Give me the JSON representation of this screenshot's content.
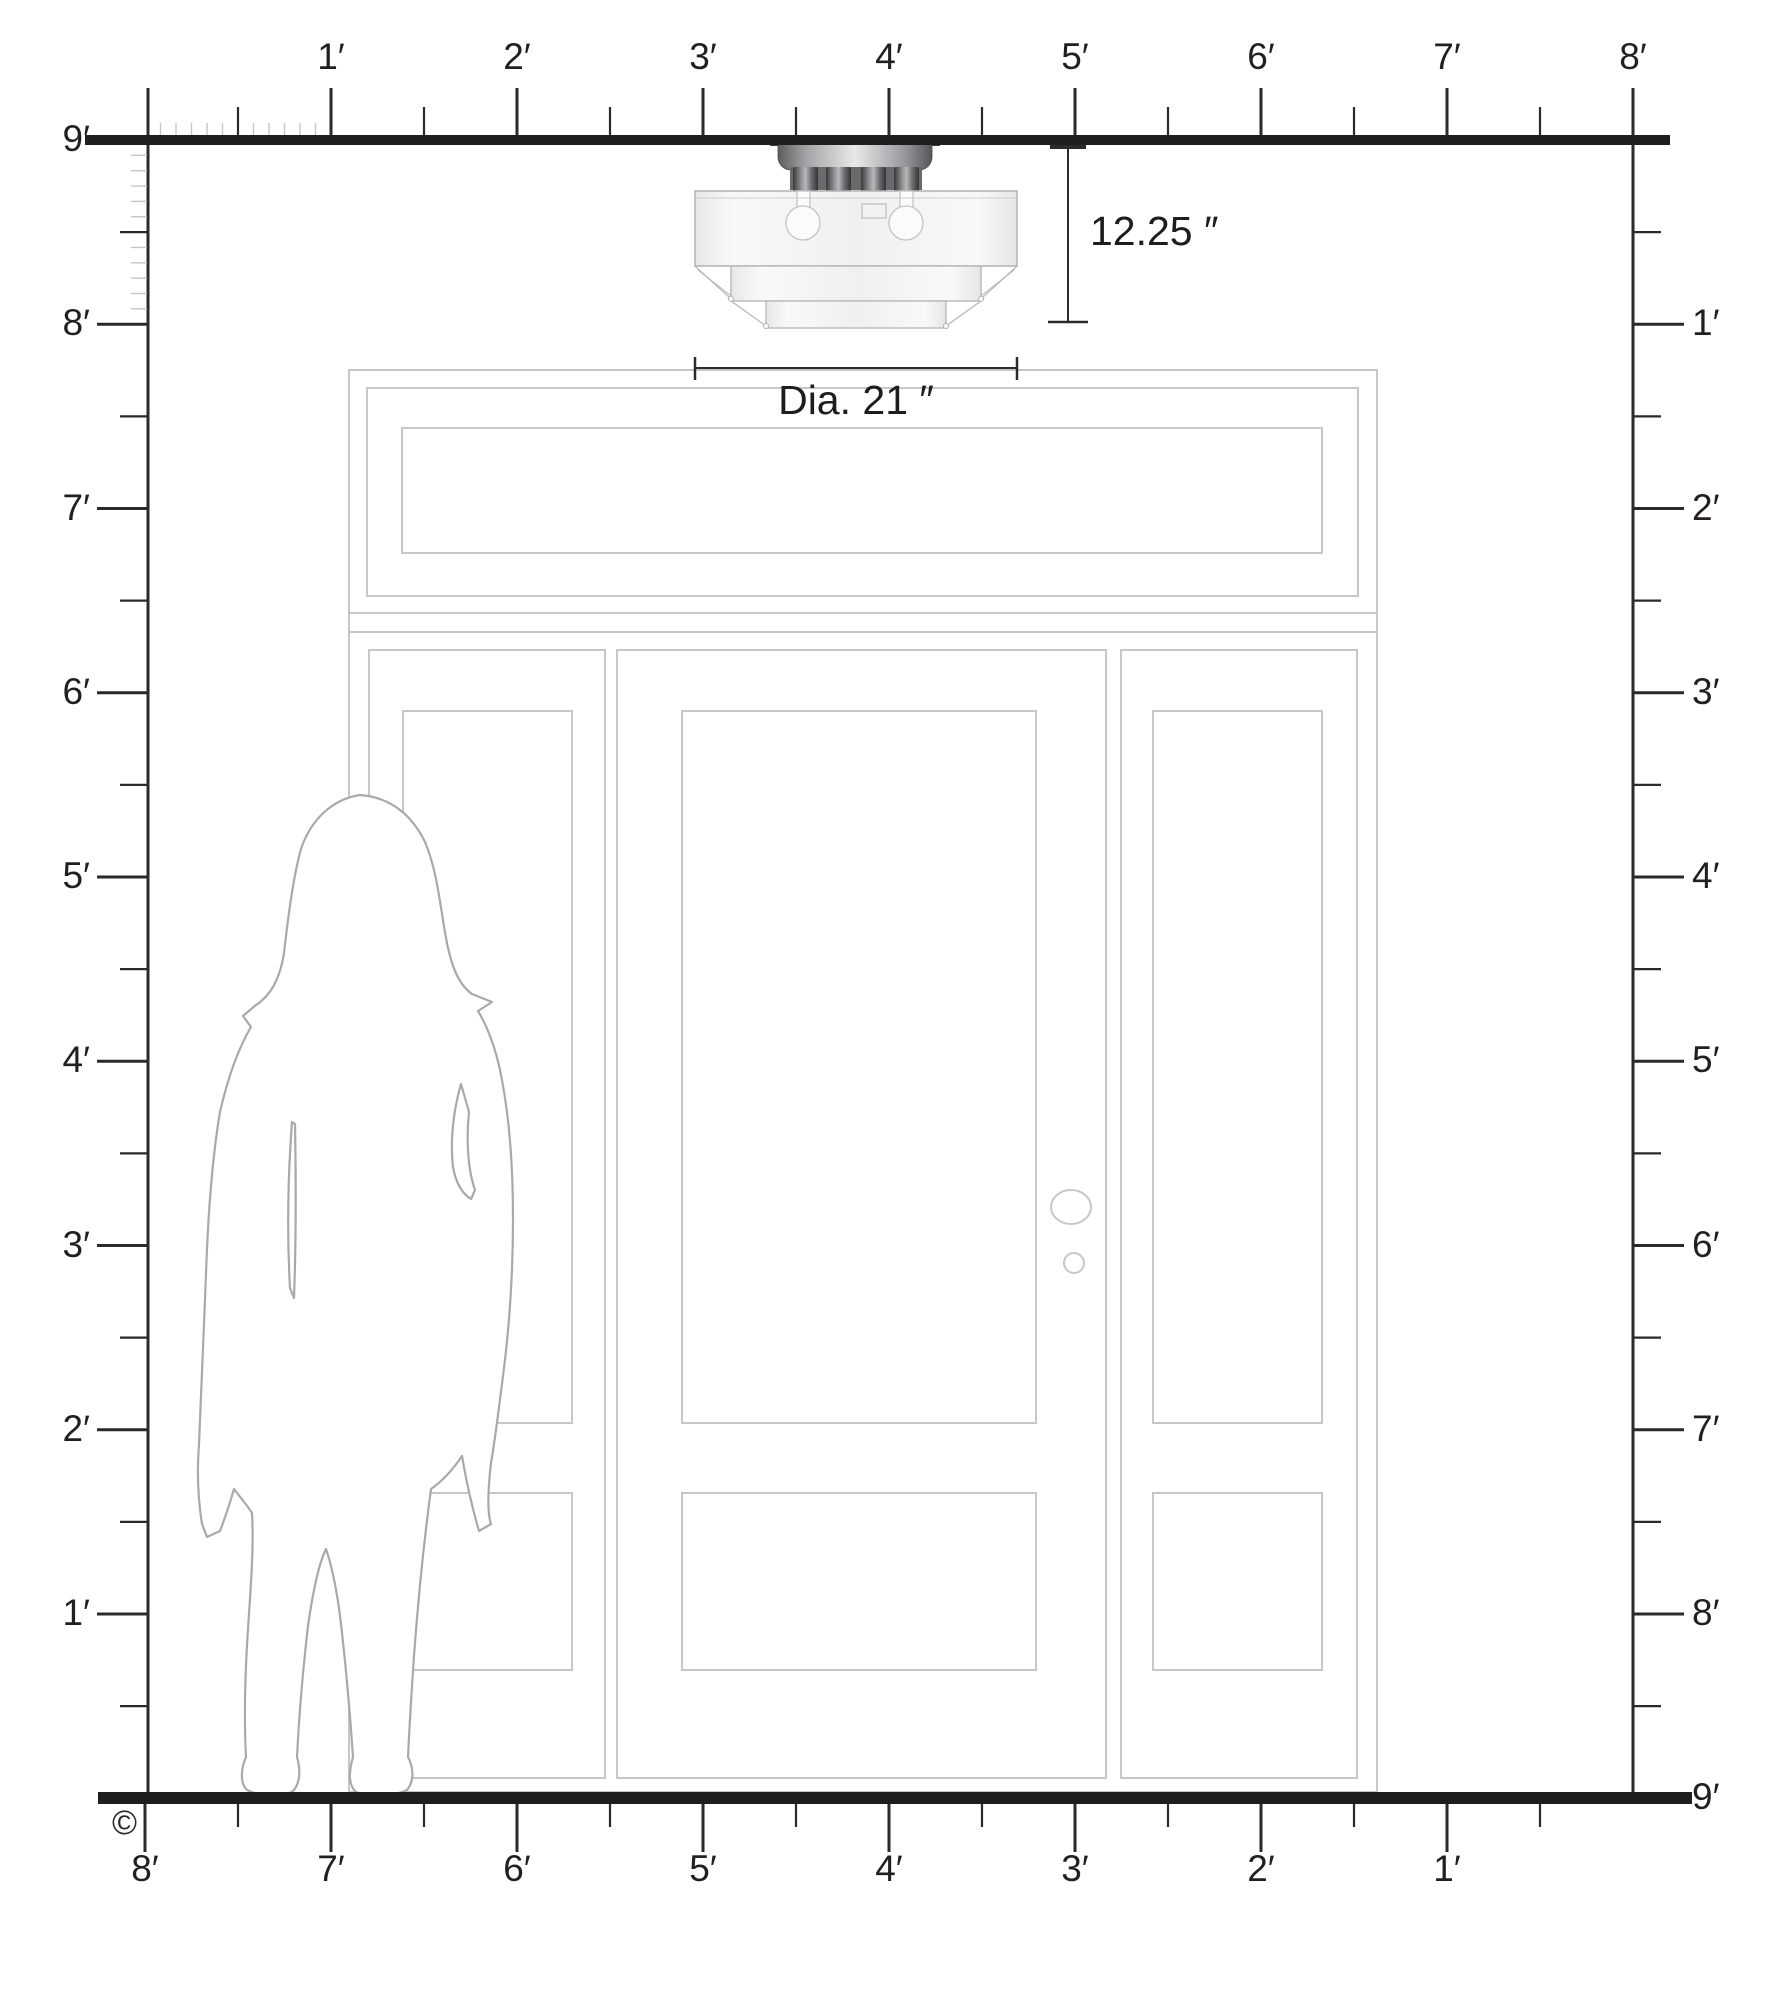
{
  "rulers": {
    "top": {
      "labels": [
        "1′",
        "2′",
        "3′",
        "4′",
        "5′",
        "6′",
        "7′",
        "8′"
      ]
    },
    "bottom": {
      "labels": [
        "8′",
        "7′",
        "6′",
        "5′",
        "4′",
        "3′",
        "2′",
        "1′"
      ]
    },
    "left": {
      "labels": [
        "9′",
        "8′",
        "7′",
        "6′",
        "5′",
        "4′",
        "3′",
        "2′",
        "1′"
      ]
    },
    "right": {
      "labels": [
        "1′",
        "2′",
        "3′",
        "4′",
        "5′",
        "6′",
        "7′",
        "8′",
        "9′"
      ]
    }
  },
  "dimensions": {
    "fixture_height": "12.25 ″",
    "fixture_diameter": "Dia. 21 ″"
  },
  "footer": {
    "copyright": "©"
  },
  "colors": {
    "ink": "#231f20",
    "door_outline": "#c7c7c9",
    "silhouette_outline": "#a9a9ab",
    "glass_fill": "#f4f4f5",
    "metal_dark": "#4a4a4d"
  }
}
